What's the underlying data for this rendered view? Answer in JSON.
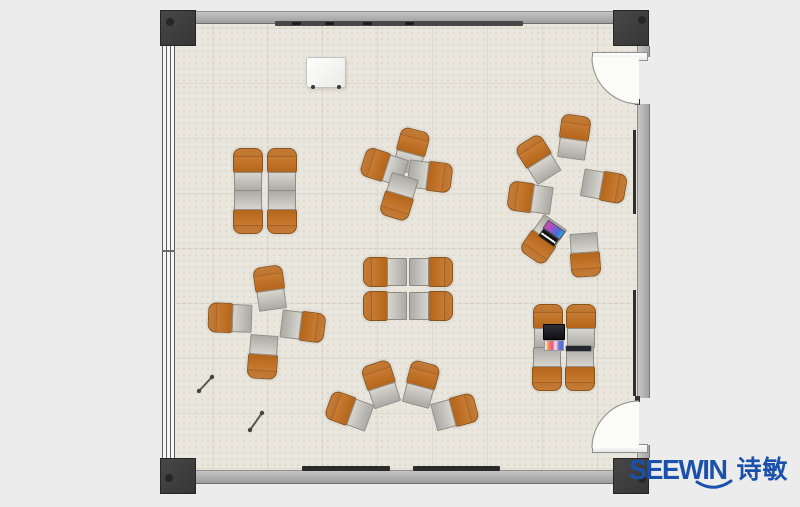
{
  "meta": {
    "width": 800,
    "height": 507,
    "description": "top-view rendered floor plan of a training room with tablet-arm chairs"
  },
  "brand": {
    "name_en": "SEEWIN",
    "name_cn": "诗敏",
    "color": "#1a51ad"
  },
  "palette": {
    "background": "#ececec",
    "floor": "#e9e6dd",
    "floor_grid": "#dcd9ce",
    "wall": "#a8a8a8",
    "column": "#3d3d3d",
    "chair_orange": "#c27229",
    "desk_gray": "#bfbcb6",
    "door_swing": "#fbfbf8",
    "board_dark": "#474747"
  },
  "room": {
    "floor": {
      "x": 175,
      "y": 24,
      "w": 462,
      "h": 446
    },
    "columns": [
      {
        "x": 160,
        "y": 10,
        "w": 36,
        "h": 36,
        "dot": {
          "dx": 5,
          "dy": 7
        }
      },
      {
        "x": 613,
        "y": 10,
        "w": 36,
        "h": 36,
        "dot": {
          "dx": 24,
          "dy": 5
        }
      },
      {
        "x": 160,
        "y": 458,
        "w": 36,
        "h": 36,
        "dot": {
          "dx": 4,
          "dy": 15
        }
      },
      {
        "x": 613,
        "y": 458,
        "w": 36,
        "h": 36,
        "dot": {
          "dx": 24,
          "dy": 16
        }
      }
    ],
    "walls_h": [
      {
        "x": 196,
        "y": 11,
        "w": 417,
        "h": 13
      },
      {
        "x": 196,
        "y": 470,
        "w": 417,
        "h": 14
      }
    ],
    "walls_v": [
      {
        "x": 637,
        "y": 46,
        "w": 13,
        "h": 11
      },
      {
        "x": 637,
        "y": 104,
        "w": 13,
        "h": 294
      },
      {
        "x": 637,
        "y": 445,
        "w": 13,
        "h": 13
      }
    ],
    "wall_strips": [
      {
        "x": 633,
        "y": 130,
        "w": 3,
        "h": 84
      },
      {
        "x": 633,
        "y": 290,
        "w": 3,
        "h": 106
      }
    ],
    "whiteboard_rail": {
      "x": 275,
      "y": 21,
      "w": 248,
      "h": 5,
      "marks": [
        17,
        50,
        88,
        130
      ]
    },
    "marker_trays": [
      {
        "x": 302,
        "y": 466,
        "w": 88,
        "h": 5
      },
      {
        "x": 413,
        "y": 466,
        "w": 87,
        "h": 5
      }
    ],
    "window_wall": {
      "x": 162,
      "y": 46,
      "w": 13,
      "h": 412,
      "tick_y": 204
    },
    "doors": [
      {
        "side": "top-right",
        "leaf": {
          "x": 592,
          "y": 52,
          "w": 56,
          "h": 9
        },
        "swing_fill": "M592,57 A47,47 0 0 0 639,104 L639,57 Z",
        "swing_arc": "M592,57 A47,47 0 0 0 639,104",
        "jamb": {
          "x": 635,
          "y": 99,
          "w": 5,
          "h": 6
        }
      },
      {
        "side": "bottom-right",
        "leaf": {
          "x": 592,
          "y": 444,
          "w": 56,
          "h": 9
        },
        "swing_fill": "M592,448 A47,47 0 0 1 639,401 L639,448 Z",
        "swing_arc": "M592,448 A47,47 0 0 1 639,401",
        "jamb": {
          "x": 635,
          "y": 396,
          "w": 5,
          "h": 6
        }
      }
    ]
  },
  "furniture": {
    "flipchart": {
      "x": 306,
      "y": 57,
      "w": 38,
      "h": 29
    },
    "clusters": [
      {
        "id": "top-left-grid",
        "units": [
          {
            "x": 248,
            "y": 170,
            "rot": 0
          },
          {
            "x": 282,
            "y": 170,
            "rot": 0
          },
          {
            "x": 248,
            "y": 212,
            "rot": 180
          },
          {
            "x": 282,
            "y": 212,
            "rot": 180
          }
        ]
      },
      {
        "id": "top-center-pinwheel",
        "units": [
          {
            "x": 411,
            "y": 151,
            "rot": 15
          },
          {
            "x": 430,
            "y": 176,
            "rot": 97
          },
          {
            "x": 384,
            "y": 167,
            "rot": 288
          },
          {
            "x": 399,
            "y": 197,
            "rot": 197
          }
        ]
      },
      {
        "id": "right-circle",
        "units": [
          {
            "x": 574,
            "y": 137,
            "rot": 8
          },
          {
            "x": 538,
            "y": 159,
            "rot": -32
          },
          {
            "x": 530,
            "y": 198,
            "rot": -82
          },
          {
            "x": 604,
            "y": 186,
            "rot": 100
          },
          {
            "x": 543,
            "y": 240,
            "rot": 215
          },
          {
            "x": 585,
            "y": 255,
            "rot": 176
          }
        ]
      },
      {
        "id": "center-grid",
        "units": [
          {
            "x": 385,
            "y": 272,
            "rot": -90
          },
          {
            "x": 431,
            "y": 272,
            "rot": 90
          },
          {
            "x": 385,
            "y": 306,
            "rot": -90
          },
          {
            "x": 431,
            "y": 306,
            "rot": 90
          }
        ]
      },
      {
        "id": "left-pinwheel",
        "units": [
          {
            "x": 270,
            "y": 288,
            "rot": -8
          },
          {
            "x": 230,
            "y": 318,
            "rot": 272
          },
          {
            "x": 303,
            "y": 326,
            "rot": 97
          },
          {
            "x": 263,
            "y": 357,
            "rot": 184
          }
        ]
      },
      {
        "id": "bottom-fan",
        "units": [
          {
            "x": 349,
            "y": 411,
            "rot": -70
          },
          {
            "x": 381,
            "y": 384,
            "rot": -18
          },
          {
            "x": 421,
            "y": 384,
            "rot": 15
          },
          {
            "x": 455,
            "y": 412,
            "rot": 75
          }
        ]
      },
      {
        "id": "bottom-right-grid",
        "units": [
          {
            "x": 548,
            "y": 326,
            "rot": 0
          },
          {
            "x": 581,
            "y": 326,
            "rot": 0
          },
          {
            "x": 547,
            "y": 369,
            "rot": 180
          },
          {
            "x": 580,
            "y": 369,
            "rot": 180
          }
        ]
      }
    ],
    "items": [
      {
        "type": "laptop",
        "x": 543,
        "y": 324,
        "w": 22,
        "h": 27,
        "rot": 0
      },
      {
        "type": "laptop2",
        "x": 541,
        "y": 224,
        "w": 21,
        "h": 19,
        "rot": 35
      },
      {
        "type": "tablet",
        "x": 566,
        "y": 346,
        "w": 25,
        "h": 5,
        "rot": 0
      },
      {
        "type": "stick",
        "x1": 199,
        "y1": 391,
        "x2": 212,
        "y2": 377
      },
      {
        "type": "stick",
        "x1": 250,
        "y1": 430,
        "x2": 262,
        "y2": 413
      }
    ]
  }
}
